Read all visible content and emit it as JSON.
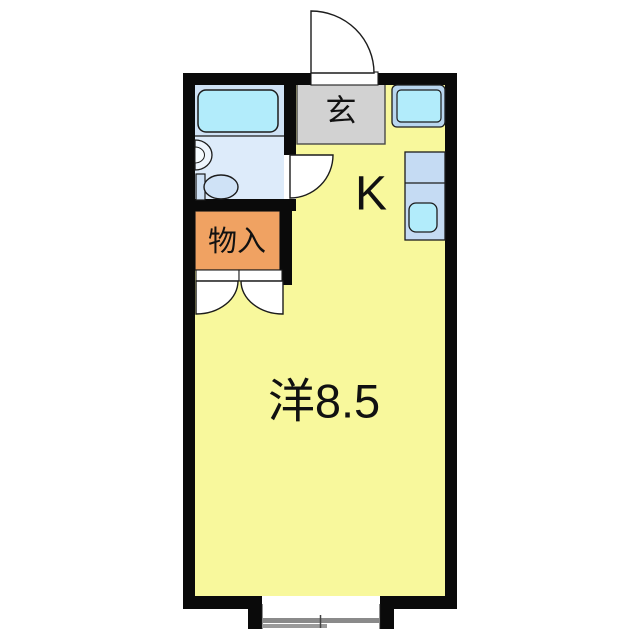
{
  "plan": {
    "type": "japanese-apartment-floor-plan",
    "rooms": {
      "entrance": {
        "label": "玄"
      },
      "kitchen": {
        "label": "K"
      },
      "western_room": {
        "label": "洋8.5"
      },
      "storage": {
        "label": "物入"
      },
      "bathroom": {
        "label": ""
      }
    },
    "fixtures": [
      "bathtub",
      "washbasin",
      "toilet",
      "washer-space",
      "kitchen-counter",
      "kitchen-sink",
      "entry-swing-door",
      "bathroom-swing-door",
      "closet-double-doors",
      "sliding-window"
    ]
  },
  "colors": {
    "wall_black": "#0a0a0a",
    "outline": "#1c1c1c",
    "floor_yellow": "#f8f89c",
    "genkan_gray": "#d2d2d2",
    "storage_orange": "#f0a262",
    "bathroom_upper": "#cfe2f5",
    "bathroom_lower": "#ddebfa",
    "fixture_cyan": "#b2ecfb",
    "fixture_blue": "#c5dbf3",
    "washer_frame_blue": "#b9d6ef",
    "toilet_blue": "#cfe2f6",
    "basin_white": "#eef5fd",
    "window_gray": "#8a8a8a"
  }
}
